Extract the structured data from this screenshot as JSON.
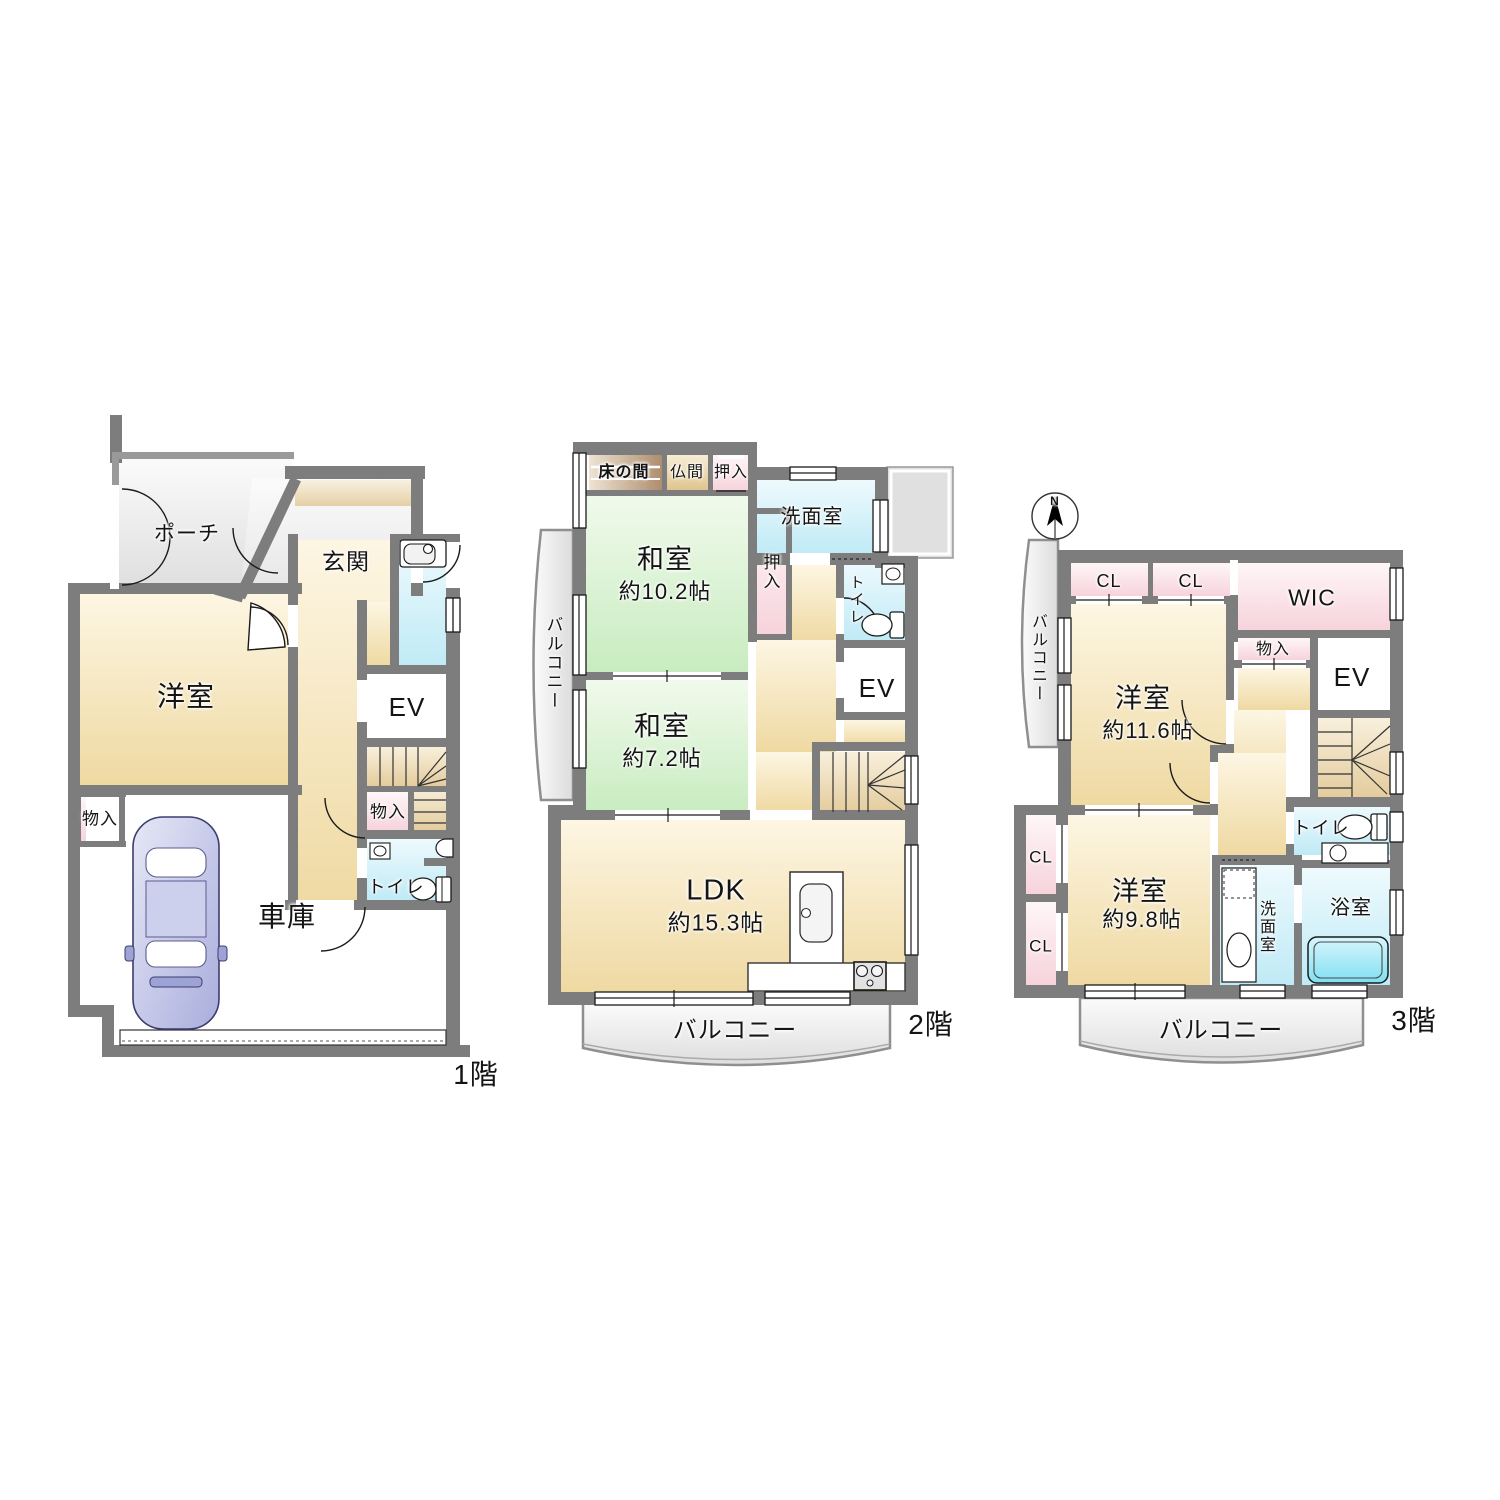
{
  "title": "間取り図（3階建て住宅）",
  "colors": {
    "wall": "#7d7d7d",
    "room_tan": "#efd9a2",
    "room_green": "#c8ecc0",
    "closet_pink": "#f7d3dc",
    "wet_cyan": "#bfeaf6",
    "porch_gray": "#e3e3e3",
    "tokonoma_brown": "#ae8d6e",
    "butsuma_beige": "#dfc38c",
    "stairs_tan": "#efdca8",
    "bathtub_cyan": "#7fdff2",
    "car_lavender": "#a9addc"
  },
  "floors": {
    "f1": {
      "floor_label": "1階",
      "rooms": {
        "porch": "ポーチ",
        "genkan": "玄関",
        "western_room": "洋室",
        "elevator": "EV",
        "storage_left": "物入",
        "storage_right": "物入",
        "toilet": "トイレ",
        "garage": "車庫"
      }
    },
    "f2": {
      "floor_label": "2階",
      "rooms": {
        "tokonoma": "床の間",
        "butsuma": "仏間",
        "oshiire_top": "押入",
        "washitsu_1": "和室",
        "washitsu_1_size": "約10.2帖",
        "oshiire": "押入",
        "washroom": "洗面室",
        "toilet": "トイレ",
        "elevator": "EV",
        "washitsu_2": "和室",
        "washitsu_2_size": "約7.2帖",
        "ldk": "LDK",
        "ldk_size": "約15.3帖",
        "balcony_left": "バルコニー",
        "balcony": "バルコニー"
      }
    },
    "f3": {
      "floor_label": "3階",
      "compass_north": "N",
      "rooms": {
        "closet_1": "CL",
        "closet_2": "CL",
        "wic": "WIC",
        "storage": "物入",
        "elevator": "EV",
        "western_room_1": "洋室",
        "western_room_1_size": "約11.6帖",
        "balcony_left": "バルコニー",
        "closet_3": "CL",
        "closet_4": "CL",
        "western_room_2": "洋室",
        "western_room_2_size": "約9.8帖",
        "washroom": "洗面室",
        "bathroom": "浴室",
        "toilet": "トイレ",
        "balcony": "バルコニー"
      }
    }
  }
}
